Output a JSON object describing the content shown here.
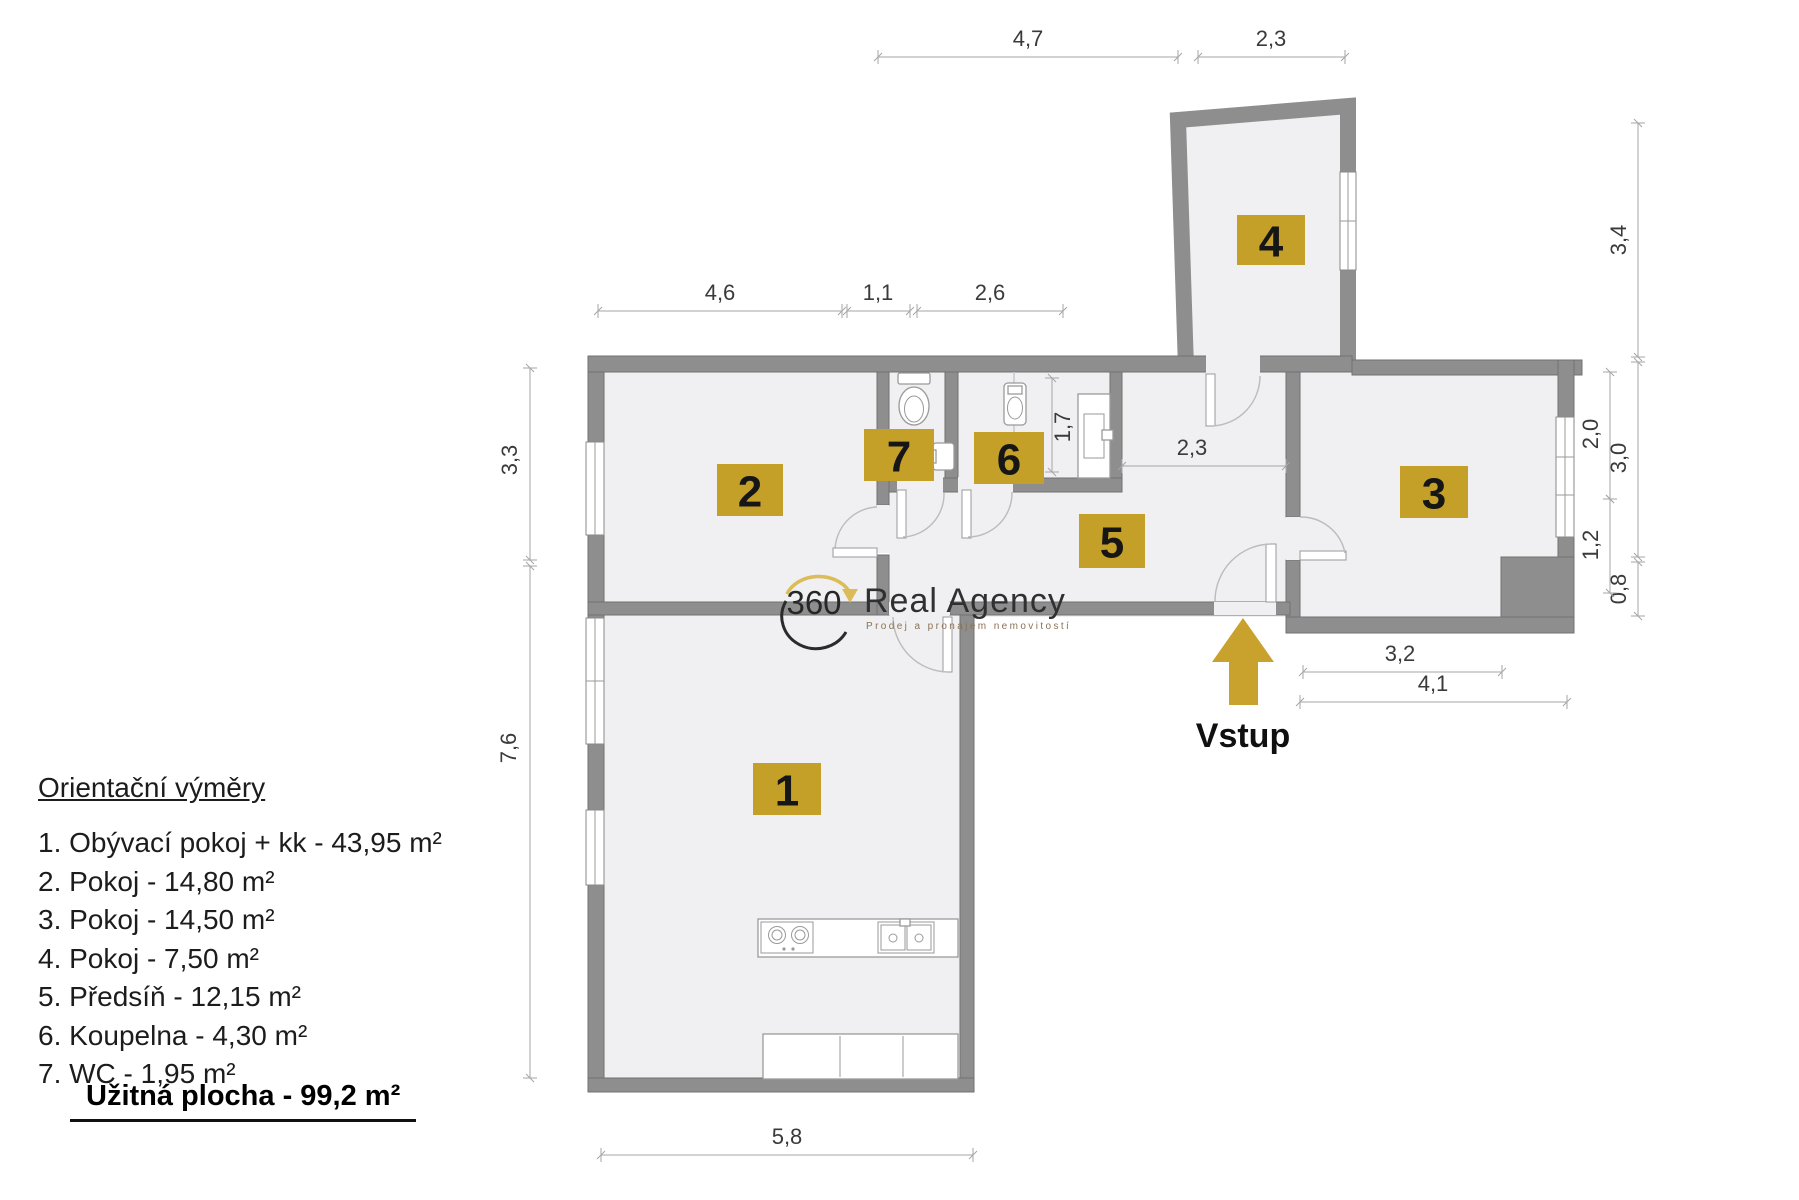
{
  "plan": {
    "rooms": [
      {
        "number": "1"
      },
      {
        "number": "2"
      },
      {
        "number": "3"
      },
      {
        "number": "4"
      },
      {
        "number": "5"
      },
      {
        "number": "6"
      },
      {
        "number": "7"
      }
    ],
    "entrance_label": "Vstup",
    "dimensions": {
      "top": [
        "4,7",
        "2,3"
      ],
      "upper": [
        "4,6",
        "1,1",
        "2,6"
      ],
      "left": [
        "3,3",
        "7,6"
      ],
      "right_outer": [
        "3,4",
        "3,0",
        "0,8"
      ],
      "right_inner": [
        "2,0",
        "1,2"
      ],
      "bottom_right": [
        "3,2",
        "4,1"
      ],
      "bottom": [
        "5,8"
      ],
      "bath": "1,7",
      "corridor": "2,3"
    }
  },
  "legend": {
    "title": "Orientační výměry",
    "items": [
      {
        "text": "1. Obývací pokoj + kk - 43,95 m²"
      },
      {
        "text": "2. Pokoj - 14,80 m²"
      },
      {
        "text": "3. Pokoj - 14,50 m²"
      },
      {
        "text": "4. Pokoj - 7,50 m²"
      },
      {
        "text": "5. Předsíň - 12,15 m²"
      },
      {
        "text": "6. Koupelna - 4,30 m²"
      },
      {
        "text": "7. WC - 1,95 m²"
      }
    ],
    "total": "Užitná plocha - 99,2 m²"
  },
  "logo": {
    "mark": "360",
    "brand": "Real Agency",
    "tagline": "Prodej a pronájem nemovitostí"
  },
  "colors": {
    "badge_gold": "#c5a028",
    "arrow_gold": "#c9a22d",
    "wall_gray": "#8e8e8e",
    "floor_gray": "#f0eff1",
    "logo_gold": "#dcbc58"
  }
}
